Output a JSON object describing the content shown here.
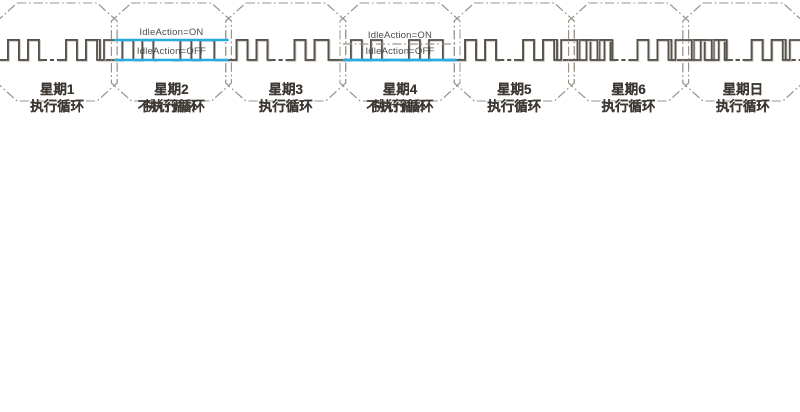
{
  "diagram": {
    "background": "#ffffff",
    "colors": {
      "waveform": "#56514b",
      "frame": "#9a948c",
      "idle_line": "#29abe2",
      "label_text": "#3d3833",
      "idle_text": "#4c4c4c"
    },
    "rows": [
      {
        "name": "all-days-run",
        "cells": [
          {
            "day": "星期1",
            "action": "执行循环",
            "type": "cycle"
          },
          {
            "day": "星期2",
            "action": "执行循环",
            "type": "cycle"
          },
          {
            "day": "星期3",
            "action": "执行循环",
            "type": "cycle"
          },
          {
            "day": "星期4",
            "action": "执行循环",
            "type": "cycle"
          },
          {
            "day": "星期5",
            "action": "执行循环",
            "type": "cycle"
          },
          {
            "day": "星期6",
            "action": "执行循环",
            "type": "cycle"
          },
          {
            "day": "星期日",
            "action": "执行循环",
            "type": "cycle_tail"
          }
        ]
      },
      {
        "name": "idle-action-off",
        "cells": [
          {
            "day": "星期1",
            "action": "执行循环",
            "type": "cycle"
          },
          {
            "day": "星期2",
            "action": "不执行循环",
            "type": "idle_off",
            "idle_label": "IdleAction=OFF"
          },
          {
            "day": "星期3",
            "action": "执行循环",
            "type": "cycle"
          },
          {
            "day": "星期4",
            "action": "不执行循环",
            "type": "idle_off",
            "idle_label": "IdleAction=OFF"
          },
          {
            "day": "星期5",
            "action": "执行循环",
            "type": "cycle"
          },
          {
            "day": "星期6",
            "action": "执行循环",
            "type": "cycle"
          },
          {
            "day": "星期日",
            "action": "执行循环",
            "type": "cycle_tail"
          }
        ]
      },
      {
        "name": "idle-action-on",
        "cells": [
          {
            "day": "星期1",
            "action": "执行循环",
            "type": "cycle_end_high"
          },
          {
            "day": "星期2",
            "action": "不执行循环",
            "type": "idle_on_high",
            "idle_label": "IdleAction=ON"
          },
          {
            "day": "星期3",
            "action": "执行循环",
            "type": "cycle"
          },
          {
            "day": "星期4",
            "action": "不执行循环",
            "type": "idle_on_low",
            "idle_label": "IdleAction=ON"
          },
          {
            "day": "星期5",
            "action": "执行循环",
            "type": "cycle_end_high"
          },
          {
            "day": "星期6",
            "action": "执行循环",
            "type": "cycle_start_end_high"
          },
          {
            "day": "星期日",
            "action": "执行循环",
            "type": "cycle_start_end_high"
          }
        ]
      }
    ]
  }
}
